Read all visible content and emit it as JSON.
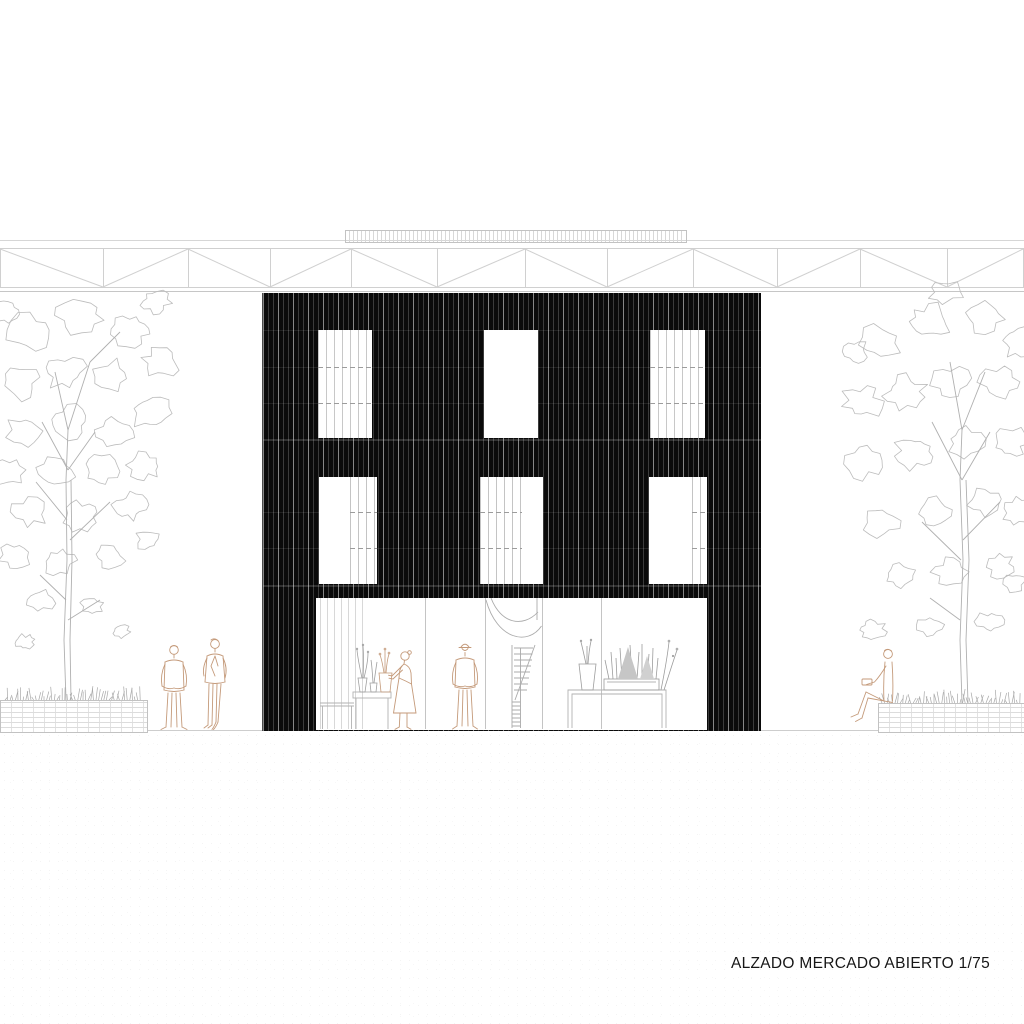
{
  "drawing": {
    "title": "ALZADO MERCADO ABIERTO 1/75",
    "name": "ALZADO MERCADO ABIERTO",
    "scale": "1/75",
    "type": "architectural elevation"
  },
  "palette": {
    "paper": "#ffffff",
    "facade_black": "#0a0a0a",
    "slat_highlight": "#4a4a4a",
    "drawing_line_gray": "#cdcdcd",
    "tree_line_gray": "#b8b8b8",
    "figure_tan": "#c49a7a",
    "plant_gray": "#a0a0a0"
  },
  "building": {
    "floors": [
      {
        "name": "second-floor",
        "windows": 3,
        "window_style": [
          "slatted",
          "open",
          "slatted"
        ]
      },
      {
        "name": "first-floor",
        "windows": 3,
        "window_style": [
          "open-with-slat-panel",
          "slatted-left",
          "open-with-slat-panel"
        ]
      },
      {
        "name": "ground-floor",
        "storefront": true,
        "contents": [
          "plant table",
          "woman figure",
          "man figure",
          "spiral staircase",
          "display table with plants"
        ]
      }
    ],
    "roof": {
      "truss": "steel lattice truss",
      "equipment": "roof railing with vertical slats"
    }
  },
  "site": {
    "left": [
      "brick planter with grass",
      "tree",
      "two standing figures"
    ],
    "right": [
      "brick planter with grass",
      "tree",
      "seated figure"
    ]
  }
}
